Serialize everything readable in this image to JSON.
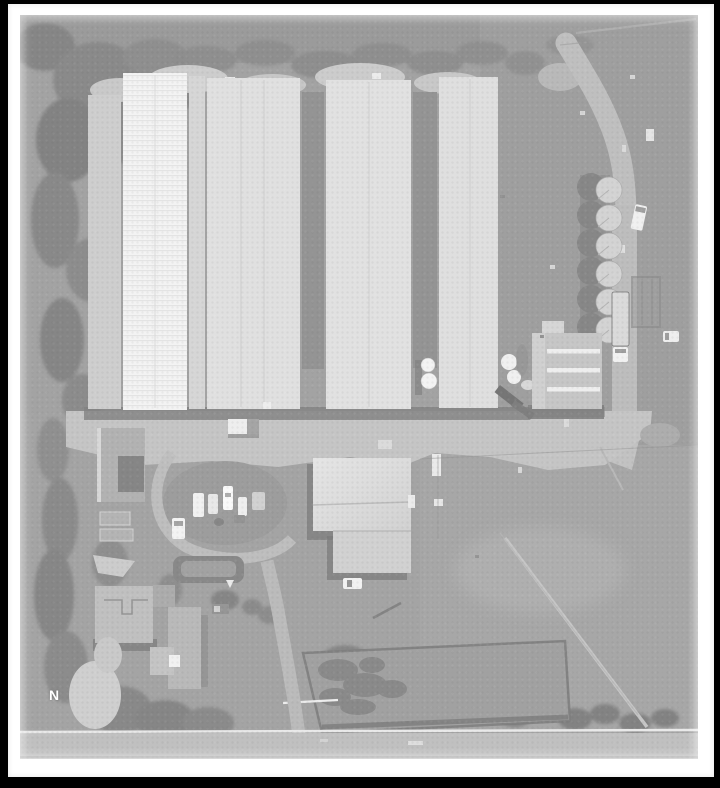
{
  "figure": {
    "type": "grayscale aerial photograph of poultry farm property",
    "north_indicator_label": "N"
  },
  "frame": {
    "border_color": "#000000",
    "mat_color": "#ffffff"
  },
  "palette": {
    "ground": "#9e9e9e",
    "field": "#9a9a9a",
    "trees": "#828282",
    "barn_roof_white": "#f3f3f3",
    "barn_roof_light": "#dcdcdc",
    "barn_gap_shadow": "#8e8e8e",
    "road": "#bdbdbd",
    "apron": "#c2c2c2",
    "building_shadow": "#787878",
    "silo": "#d1d1d1",
    "house_roof": "#bdbdbd"
  }
}
